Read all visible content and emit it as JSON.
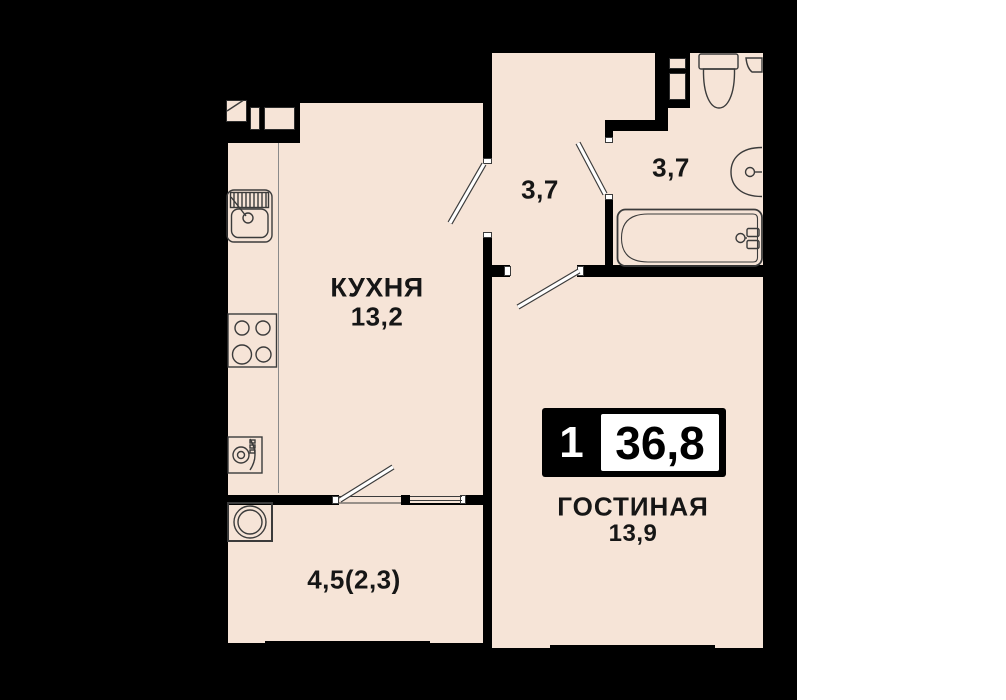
{
  "plan": {
    "type_label": "apartment floor plan",
    "badge": {
      "room_count": "1",
      "total_area": "36,8"
    },
    "rooms": {
      "kitchen": {
        "name": "КУХНЯ",
        "area": "13,2"
      },
      "hallway": {
        "name": "",
        "area": "3,7"
      },
      "bathroom": {
        "name": "",
        "area": "3,7"
      },
      "living": {
        "name": "ГОСТИНАЯ",
        "area": "13,9"
      },
      "balcony": {
        "name": "",
        "area": "4,5(2,3)"
      }
    },
    "fixtures": [
      "kitchen-sink-icon",
      "stove-icon",
      "washer-icon",
      "balcony-washer-icon",
      "toilet-icon",
      "corner-shelf-icon",
      "bath-sink-icon",
      "bathtub-icon",
      "vent-shaft-icon",
      "door-leaf-icon",
      "window-icon"
    ],
    "colors": {
      "floor": "#f6e4d7",
      "walls": "#000000",
      "fixture_line": "#3b3b3b",
      "door_leaf": "#ffffff",
      "page_margin": "#ffffff"
    }
  }
}
